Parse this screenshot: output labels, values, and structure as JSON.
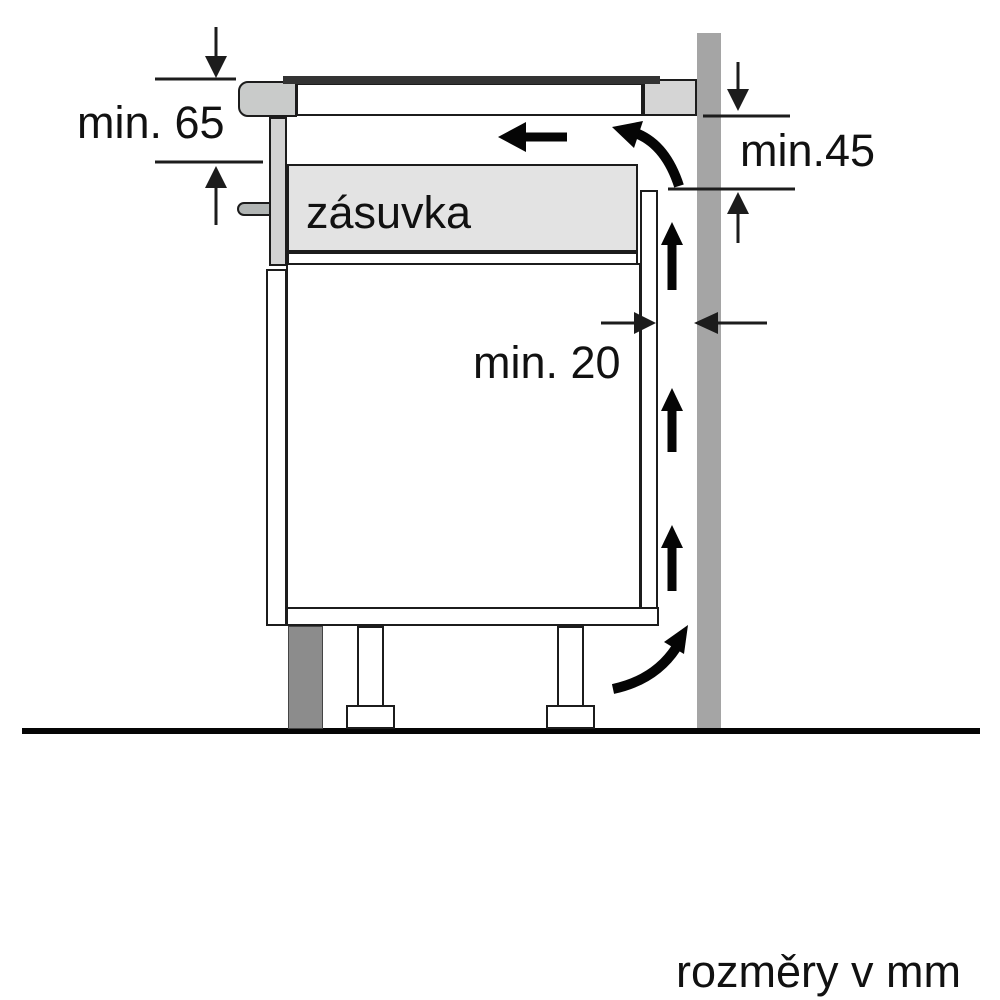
{
  "diagram": {
    "title_hint": "hob installation clearance side-section diagram",
    "labels": {
      "min65": "min. 65",
      "min45": "min.45",
      "min20": "min. 20",
      "drawer": "zásuvka",
      "footer": "rozměry v mm"
    },
    "colors": {
      "wall": "#a5a5a5",
      "plinth": "#8c8c8c",
      "drawer-fill": "#e3e3e3",
      "worktop-strip": "#d5d5d5",
      "hob-edge": "#c9cbca",
      "trim": "#d3d3d3",
      "handle": "#b1b5b4",
      "glass": "#333333",
      "line": "#1c1c1c",
      "arrow": "#050505",
      "text": "#111111",
      "bg": "#ffffff"
    }
  }
}
